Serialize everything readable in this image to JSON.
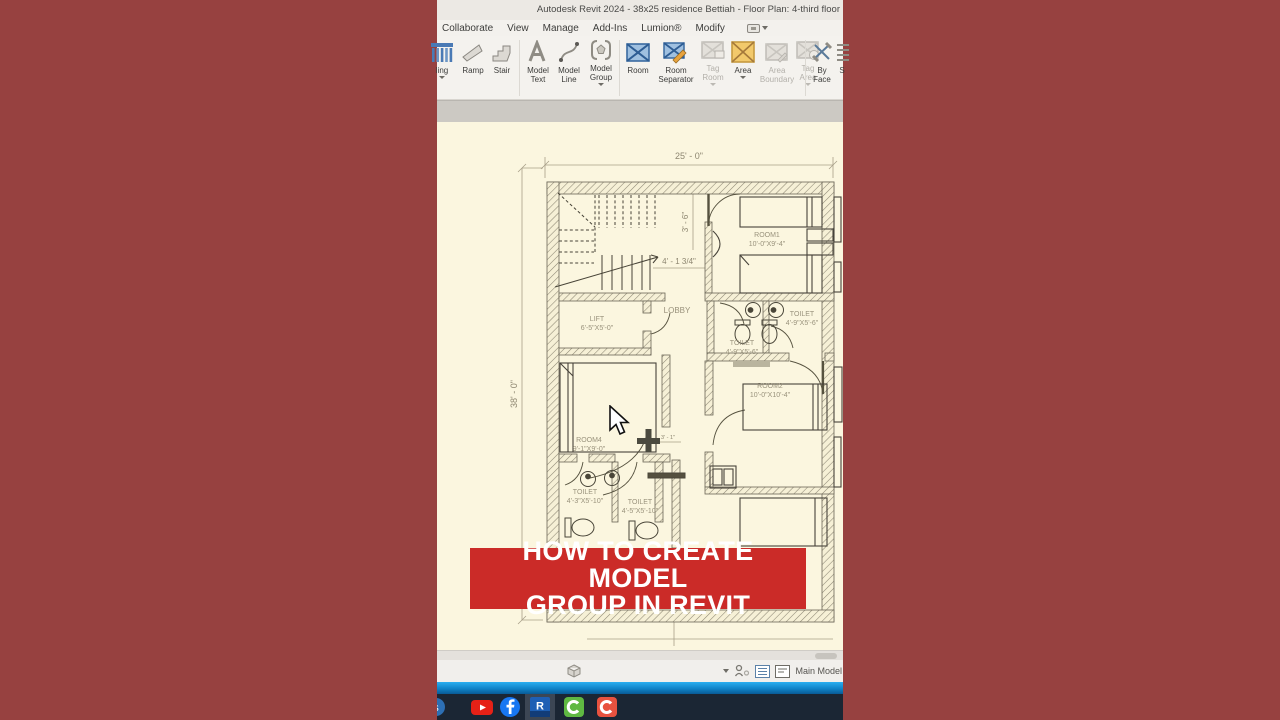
{
  "window": {
    "title": "Autodesk Revit 2024 - 38x25 residence Bettiah - Floor Plan: 4-third floor"
  },
  "menu": {
    "items": [
      "Collaborate",
      "View",
      "Manage",
      "Add-Ins",
      "Lumion®",
      "Modify"
    ]
  },
  "ribbon": {
    "groups": {
      "circulation": "Circulation",
      "model": "Model",
      "room_area": "Room & Area"
    },
    "buttons": [
      {
        "line1": "ling",
        "line2": ""
      },
      {
        "line1": "Ramp",
        "line2": ""
      },
      {
        "line1": "Stair",
        "line2": ""
      },
      {
        "line1": "Model",
        "line2": "Text"
      },
      {
        "line1": "Model",
        "line2": "Line"
      },
      {
        "line1": "Model",
        "line2": "Group"
      },
      {
        "line1": "Room",
        "line2": ""
      },
      {
        "line1": "Room",
        "line2": "Separator"
      },
      {
        "line1": "Tag",
        "line2": "Room"
      },
      {
        "line1": "Area",
        "line2": ""
      },
      {
        "line1": "Area",
        "line2": "Boundary"
      },
      {
        "line1": "Tag",
        "line2": "Area"
      },
      {
        "line1": "By",
        "line2": "Face"
      },
      {
        "line1": "S",
        "line2": ""
      }
    ]
  },
  "plan": {
    "dim_width": "25' - 0\"",
    "dim_height": "38' - 0\"",
    "dim_stair_width": "3' - 6\"",
    "dim_stair_run": "4' - 1 3/4\"",
    "dim_small": "3' - 1\"",
    "rooms": {
      "room1": {
        "name": "ROOM1",
        "size": "10'-0\"X9'-4\""
      },
      "room2": {
        "name": "ROOM2",
        "size": "10'-0\"X10'-4\""
      },
      "room4": {
        "name": "ROOM4",
        "size": "9'-1\"X9'-0\""
      },
      "lift": {
        "name": "LIFT",
        "size": "6'-5\"X5'-0\""
      },
      "lobby": {
        "name": "LOBBY"
      },
      "toilet_r1": {
        "name": "TOILET",
        "size": "4'-9\"X5'-6\""
      },
      "toilet_r2": {
        "name": "TOILET",
        "size": "4'-9\"X5'-6\""
      },
      "toilet_b1": {
        "name": "TOILET",
        "size": "4'-3\"X5'-10\""
      },
      "toilet_b2": {
        "name": "TOILET",
        "size": "4'-5\"X5'-10\""
      }
    }
  },
  "banner": {
    "line1": "HOW TO CREATE MODEL",
    "line2": "GROUP IN REVIT"
  },
  "statusbar": {
    "main_model": "Main Model"
  },
  "taskbar": {
    "icons": [
      "youtube",
      "facebook",
      "revit",
      "camtasia",
      "camtasia-recorder"
    ]
  },
  "colors": {
    "side_background": "#974140",
    "banner_red": "#cb2b28",
    "canvas_cream": "#fbf6df",
    "taskbar_navy": "#1b2634",
    "accent_blue_tool": "#5b8fc7",
    "accent_area_orange": "#f2c96b"
  }
}
